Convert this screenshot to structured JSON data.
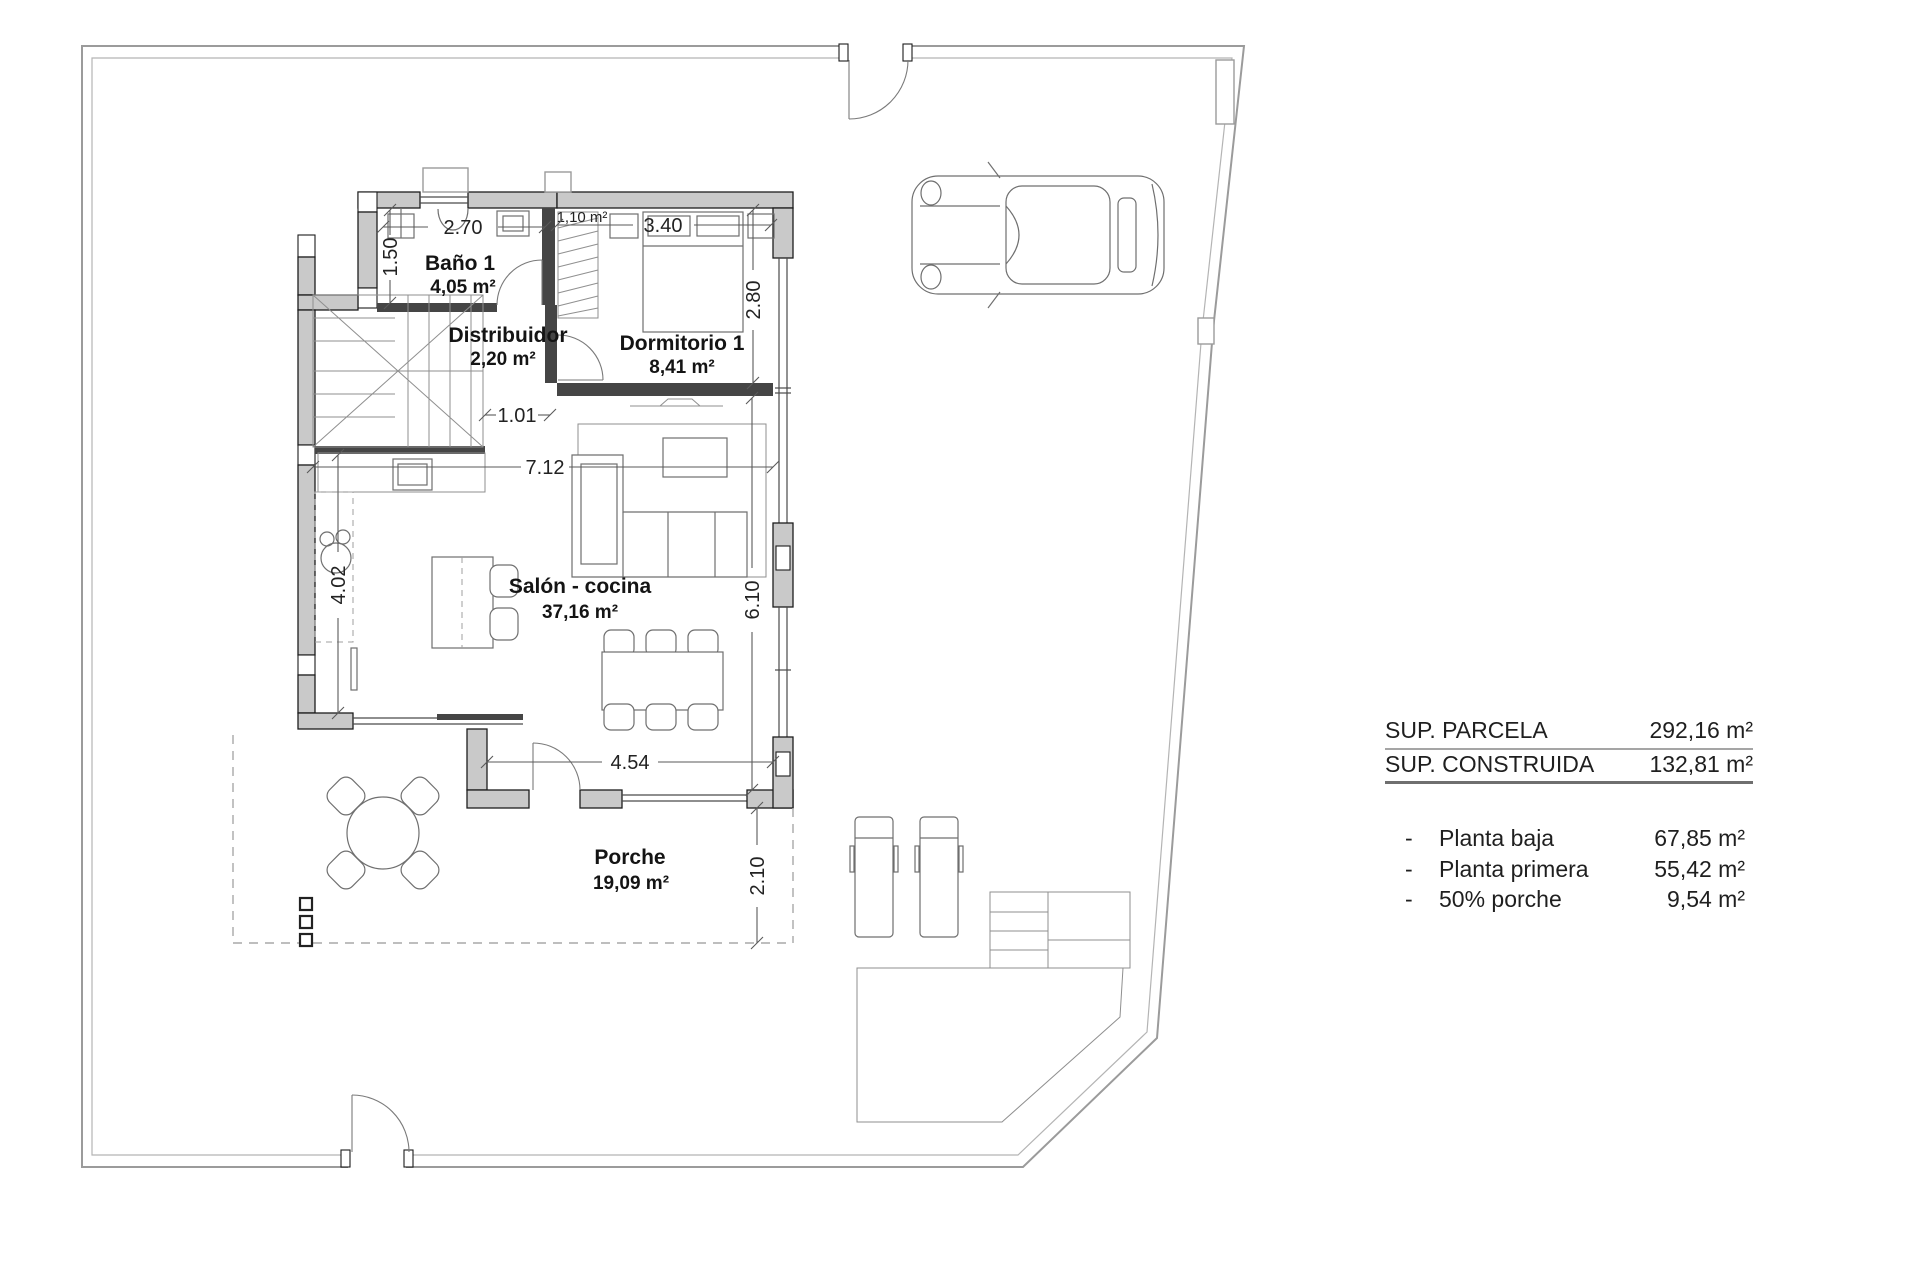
{
  "plan": {
    "rooms": [
      {
        "name": "Baño 1",
        "area": "4,05 m²"
      },
      {
        "name": "Distribuidor",
        "area": "2,20 m²"
      },
      {
        "name": "Dormitorio 1",
        "area": "8,41 m²"
      },
      {
        "name": "Salón - cocina",
        "area": "37,16 m²"
      },
      {
        "name": "Porche",
        "area": "19,09 m²"
      }
    ],
    "annotations": {
      "closet_area": "1,10 m²"
    },
    "dimensions": {
      "bano_width": "2.70",
      "bano_depth": "1.50",
      "dormitorio_width": "3.40",
      "dormitorio_depth": "2.80",
      "distribuidor_width": "1.01",
      "salon_width": "7.12",
      "salon_left_depth": "4.02",
      "salon_right_depth": "6.10",
      "porche_width": "4.54",
      "porche_depth": "2.10"
    }
  },
  "summary": {
    "totals": [
      {
        "label": "SUP. PARCELA",
        "value": "292,16 m²"
      },
      {
        "label": "SUP. CONSTRUIDA",
        "value": "132,81 m²"
      }
    ],
    "bullet": "-",
    "breakdown": [
      {
        "label": "Planta baja",
        "value": "67,85 m²"
      },
      {
        "label": "Planta primera",
        "value": "55,42 m²"
      },
      {
        "label": "50% porche",
        "value": "9,54 m²"
      }
    ]
  },
  "colors": {
    "wall_fill": "#c9c9c9",
    "wall_stroke": "#1d1d1d",
    "boundary": "#9b9b9b",
    "text": "#1f1f1f"
  }
}
